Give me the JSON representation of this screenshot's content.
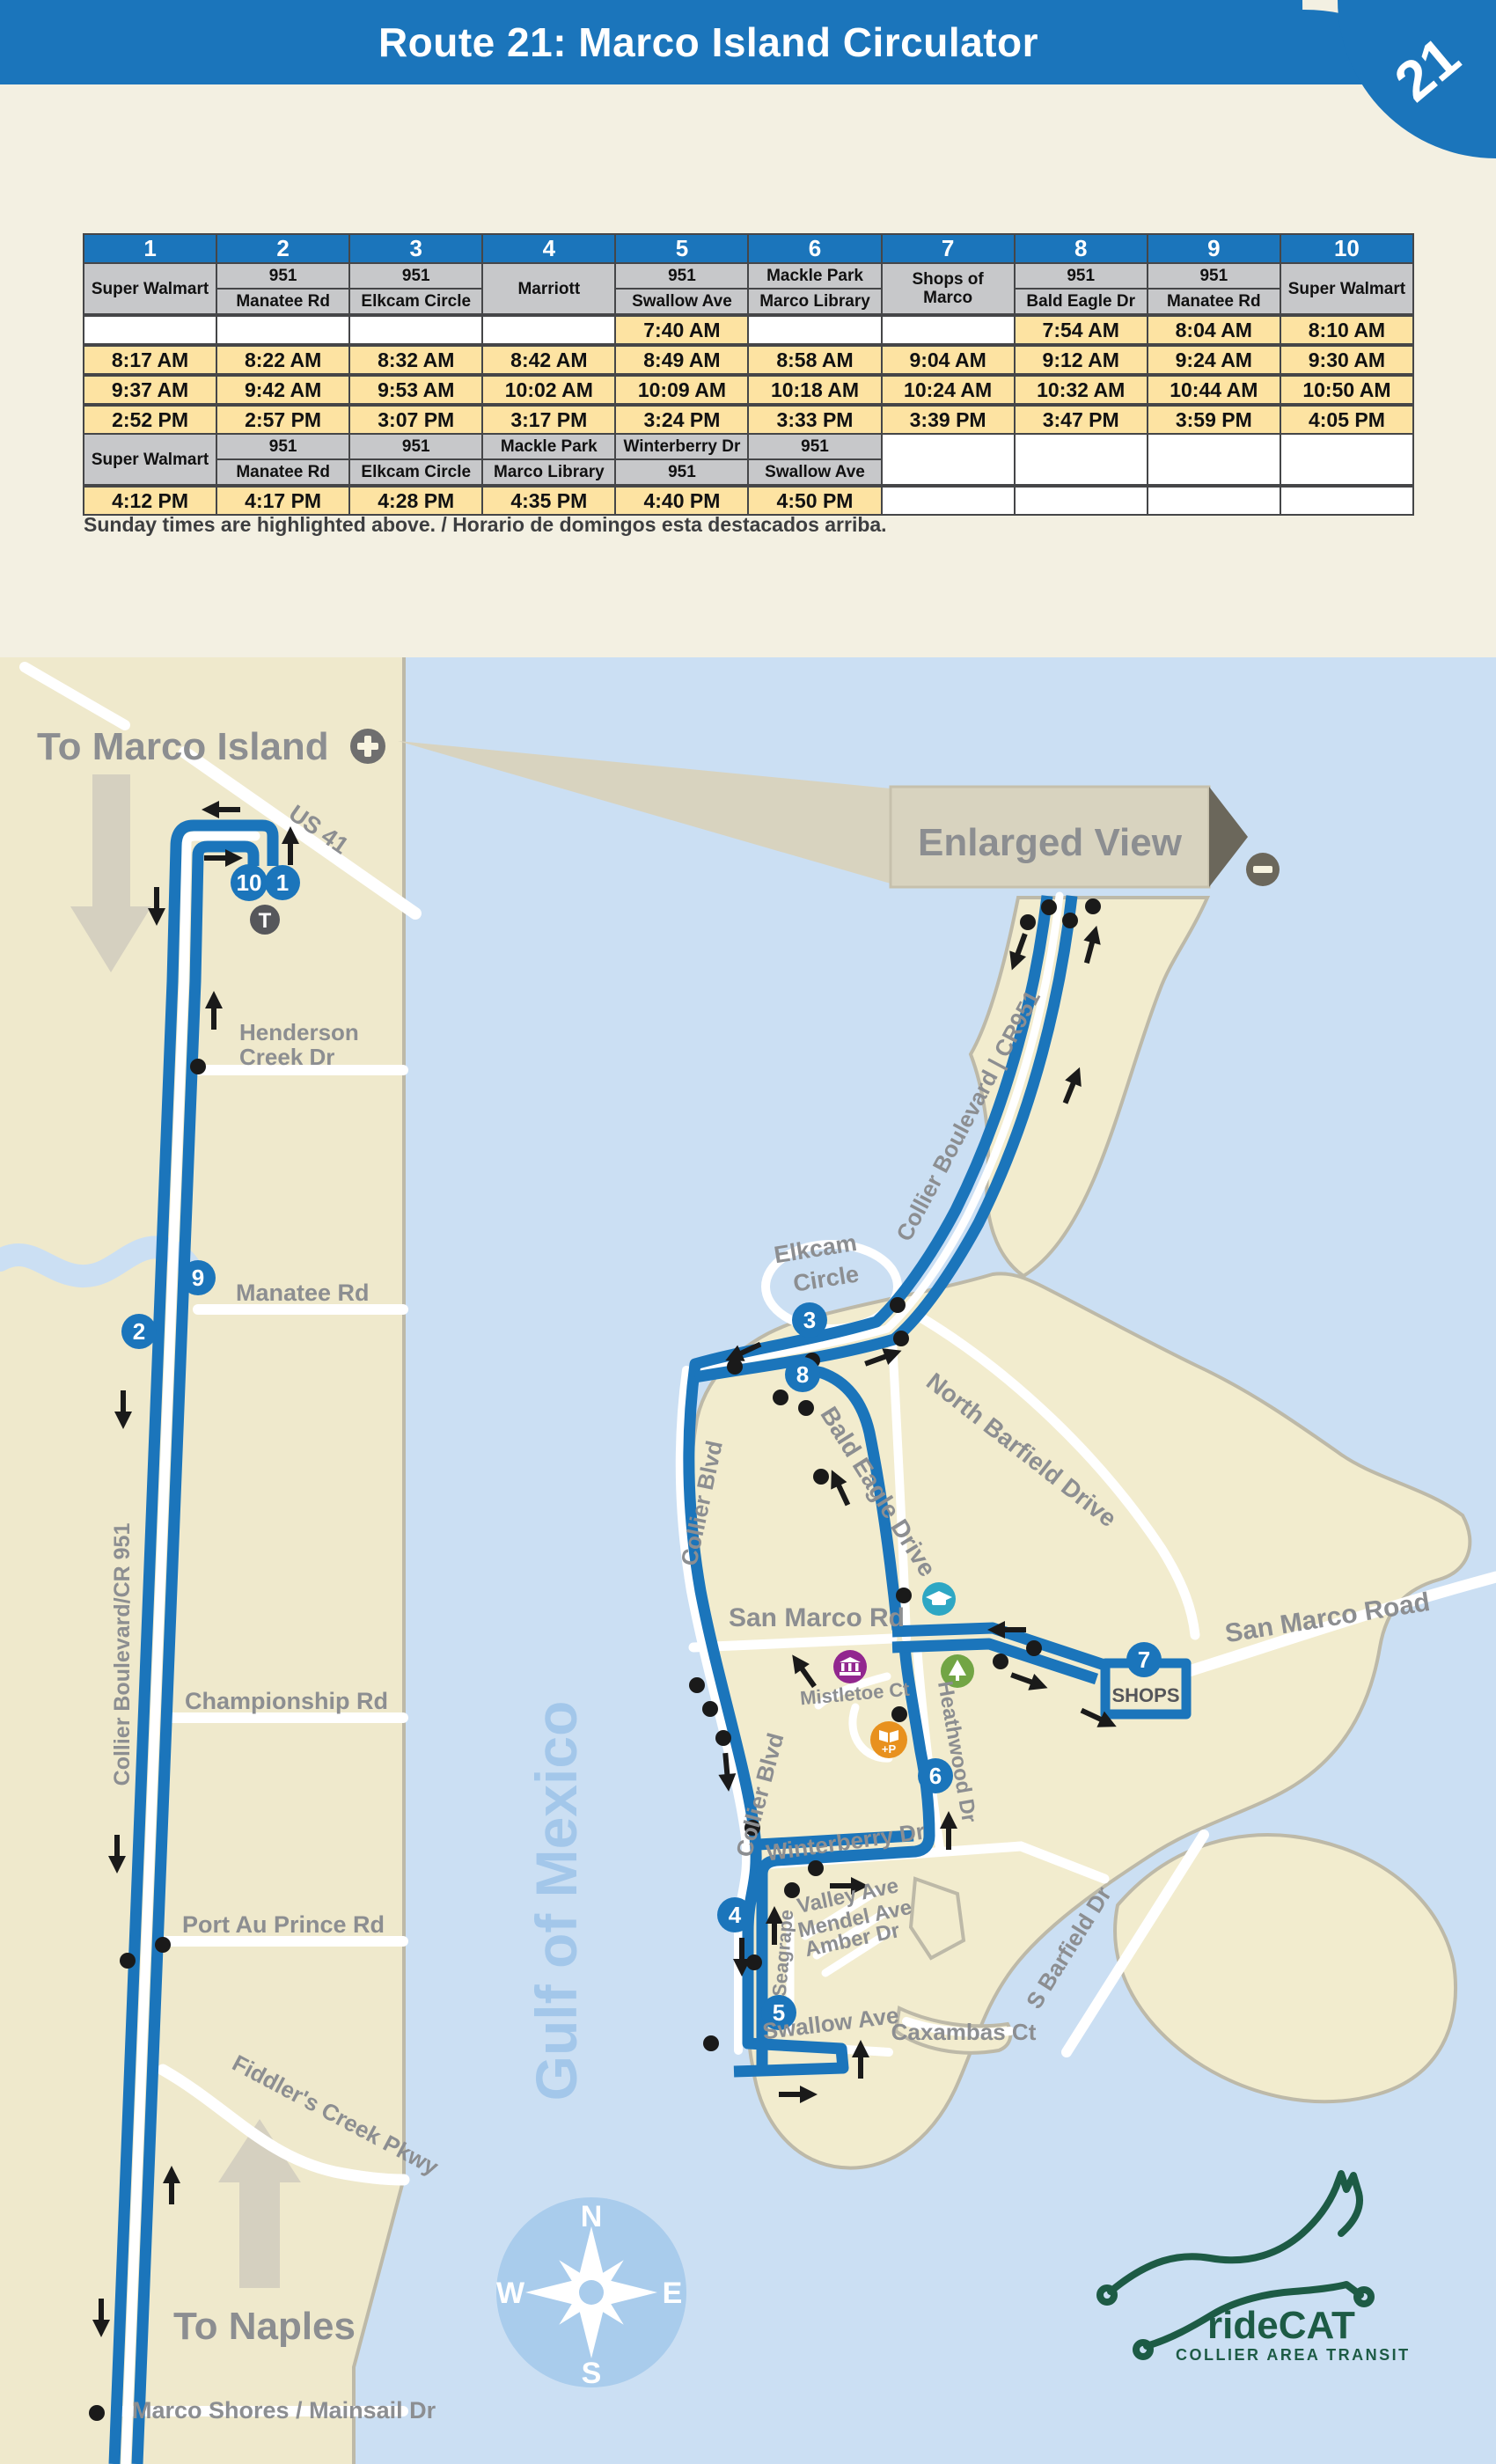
{
  "colors": {
    "accent_blue": "#1B75BB",
    "sunday_yellow": "#FDE3A2",
    "land_tan": "#EFE9CC",
    "water_blue": "#CBDFF3",
    "logo_green": "#1D5B45"
  },
  "header": {
    "title": "Route 21: Marco Island Circulator",
    "badge": "21"
  },
  "timetable": {
    "stop_numbers": [
      "1",
      "2",
      "3",
      "4",
      "5",
      "6",
      "7",
      "8",
      "9",
      "10"
    ],
    "section1": {
      "names": [
        {
          "top": "Super Walmart"
        },
        {
          "top": "951",
          "bottom": "Manatee Rd"
        },
        {
          "top": "951",
          "bottom": "Elkcam Circle"
        },
        {
          "top": "Marriott"
        },
        {
          "top": "951",
          "bottom": "Swallow Ave"
        },
        {
          "top": "Mackle Park",
          "bottom": "Marco Library"
        },
        {
          "top": "Shops of Marco"
        },
        {
          "top": "951",
          "bottom": "Bald Eagle Dr"
        },
        {
          "top": "951",
          "bottom": "Manatee Rd"
        },
        {
          "top": "Super Walmart"
        }
      ],
      "rows": [
        [
          "",
          "",
          "",
          "",
          "7:40 AM",
          "",
          "",
          "7:54 AM",
          "8:04 AM",
          "8:10 AM"
        ],
        [
          "8:17 AM",
          "8:22 AM",
          "8:32 AM",
          "8:42 AM",
          "8:49 AM",
          "8:58 AM",
          "9:04 AM",
          "9:12 AM",
          "9:24 AM",
          "9:30 AM"
        ],
        [
          "9:37 AM",
          "9:42 AM",
          "9:53 AM",
          "10:02 AM",
          "10:09 AM",
          "10:18 AM",
          "10:24 AM",
          "10:32 AM",
          "10:44 AM",
          "10:50 AM"
        ],
        [
          "2:52 PM",
          "2:57 PM",
          "3:07 PM",
          "3:17 PM",
          "3:24 PM",
          "3:33 PM",
          "3:39 PM",
          "3:47 PM",
          "3:59 PM",
          "4:05 PM"
        ]
      ]
    },
    "section2": {
      "names": [
        {
          "top": "Super Walmart"
        },
        {
          "top": "951",
          "bottom": "Manatee Rd"
        },
        {
          "top": "951",
          "bottom": "Elkcam Circle"
        },
        {
          "top": "Mackle Park",
          "bottom": "Marco Library"
        },
        {
          "top": "Winterberry Dr",
          "bottom": "951"
        },
        {
          "top": "951",
          "bottom": "Swallow Ave"
        }
      ],
      "rows": [
        [
          "4:12 PM",
          "4:17 PM",
          "4:28 PM",
          "4:35 PM",
          "4:40 PM",
          "4:50 PM",
          "",
          "",
          "",
          ""
        ]
      ]
    },
    "footnote": "Sunday times are highlighted above. / Horario de domingos esta destacados arriba."
  },
  "map": {
    "left": {
      "to_marco": "To Marco Island",
      "us41": "US 41",
      "henderson1": "Henderson",
      "henderson2": "Creek Dr",
      "manatee": "Manatee Rd",
      "collier_cr951": "Collier Boulevard/CR 951",
      "championship": "Championship Rd",
      "port_au_prince": "Port Au Prince Rd",
      "fiddlers": "Fiddler's Creek Pkwy",
      "to_naples": "To Naples",
      "marco_shores": "Marco Shores / Mainsail Dr"
    },
    "island": {
      "enlarged_view": "Enlarged View",
      "collier_cr951": "Collier Boulevard | CR951",
      "elkcam1": "Elkcam",
      "elkcam2": "Circle",
      "north_barfield": "North Barfield Drive",
      "bald_eagle": "Bald Eagle Drive",
      "collier_blvd": "Collier Blvd",
      "collier_blvd2": "Collier Blvd",
      "san_marco_rd": "San Marco Rd",
      "san_marco_road": "San Marco Road",
      "mistletoe": "Mistletoe Ct",
      "heathwood": "Heathwood Dr",
      "winterberry": "Winterberry Dr",
      "valley": "Valley Ave",
      "mendel": "Mendel Ave",
      "amber": "Amber Dr",
      "seagrape": "Seagrape",
      "swallow": "Swallow Ave",
      "caxambas": "Caxambas Ct",
      "s_barfield": "S Barfield Dr",
      "shops": "SHOPS",
      "gulf": "Gulf of Mexico"
    },
    "stops": {
      "s1": "1",
      "s2": "2",
      "s3": "3",
      "s4": "4",
      "s5": "5",
      "s6": "6",
      "s7": "7",
      "s8": "8",
      "s9": "9",
      "s10": "10",
      "transfer": "T"
    },
    "compass": {
      "n": "N",
      "e": "E",
      "s": "S",
      "w": "W"
    },
    "logo": {
      "brand": "rideCAT",
      "subtitle": "COLLIER AREA TRANSIT"
    }
  }
}
